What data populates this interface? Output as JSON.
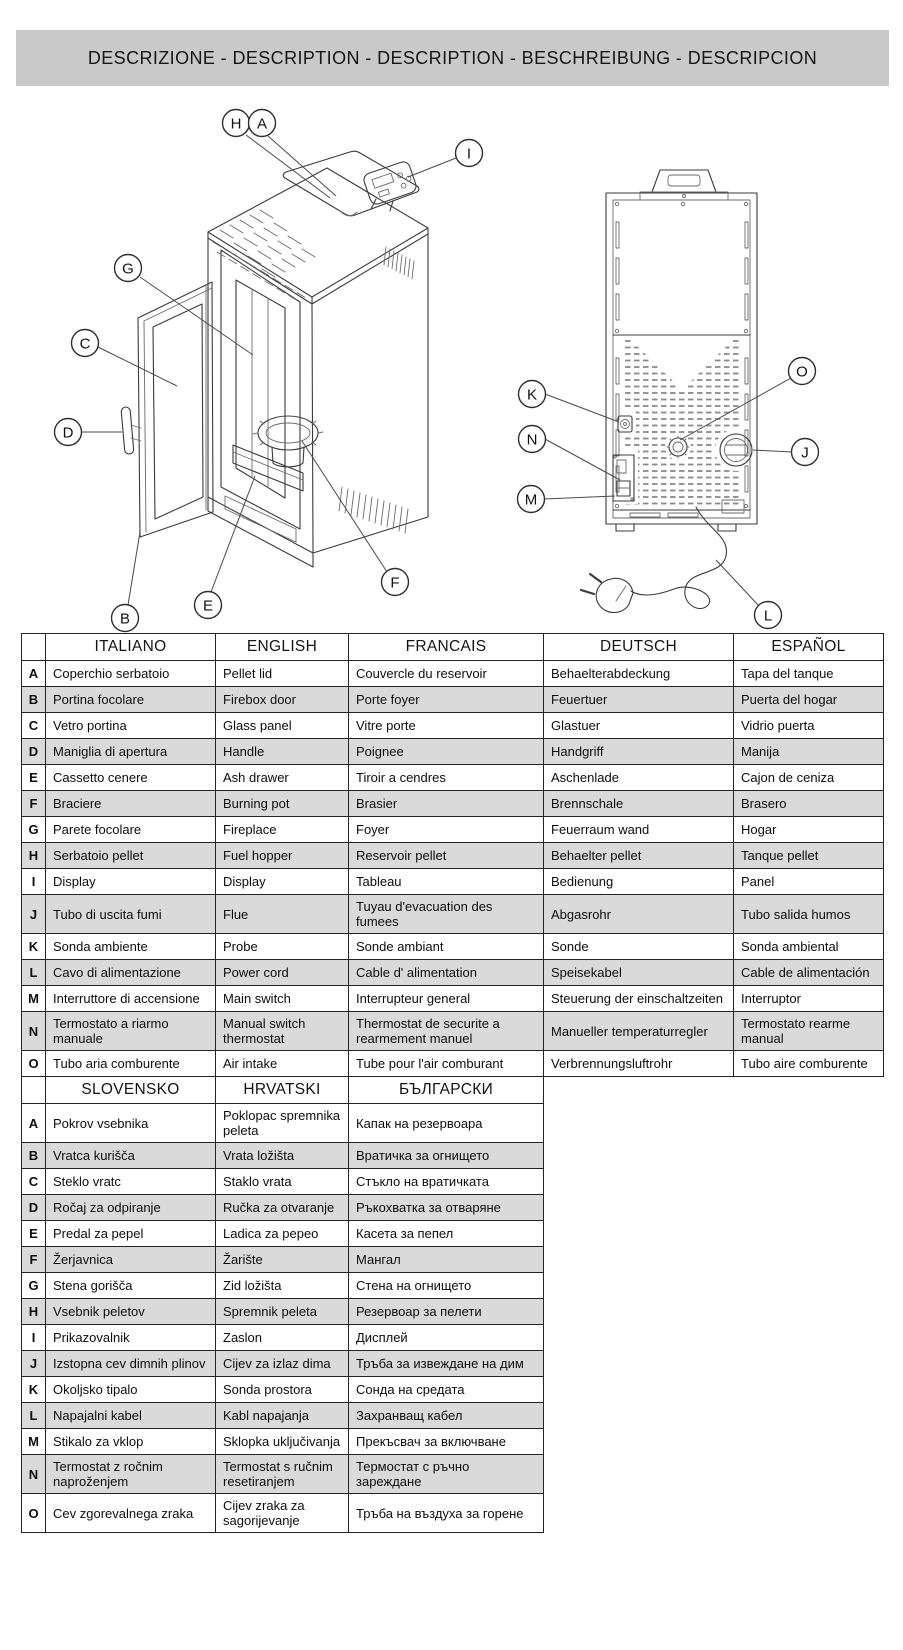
{
  "banner": {
    "title": "DESCRIZIONE - DESCRIPTION - DESCRIPTION - BESCHREIBUNG - DESCRIPCION"
  },
  "colors": {
    "banner_bg": "#c9c9c9",
    "row_alt_bg": "#dadada",
    "border": "#242424",
    "line_art": "#3b3b3b"
  },
  "diagrams": {
    "front": {
      "name": "stove-front-view",
      "callouts": [
        {
          "label": "H",
          "cx": 196,
          "cy": 28,
          "leader": [
            206,
            40,
            290,
            103
          ]
        },
        {
          "label": "A",
          "cx": 222,
          "cy": 28,
          "leader": [
            228,
            41,
            296,
            101
          ]
        },
        {
          "label": "I",
          "cx": 429,
          "cy": 58,
          "leader": [
            416,
            63,
            368,
            82
          ]
        },
        {
          "label": "G",
          "cx": 88,
          "cy": 173,
          "leader": [
            100,
            182,
            213,
            260
          ]
        },
        {
          "label": "C",
          "cx": 45,
          "cy": 248,
          "leader": [
            58,
            252,
            137,
            291
          ]
        },
        {
          "label": "D",
          "cx": 28,
          "cy": 337,
          "leader": [
            41,
            337,
            82,
            337
          ]
        },
        {
          "label": "B",
          "cx": 85,
          "cy": 523,
          "leader": [
            88,
            510,
            100,
            437
          ]
        },
        {
          "label": "E",
          "cx": 168,
          "cy": 510,
          "leader": [
            171,
            497,
            215,
            381
          ]
        },
        {
          "label": "F",
          "cx": 355,
          "cy": 487,
          "leader": [
            347,
            477,
            262,
            346
          ]
        }
      ]
    },
    "rear": {
      "name": "stove-rear-view",
      "callouts": [
        {
          "label": "K",
          "cx": 52,
          "cy": 264,
          "leader": [
            65,
            264,
            139,
            292
          ]
        },
        {
          "label": "N",
          "cx": 52,
          "cy": 309,
          "leader": [
            65,
            309,
            140,
            350
          ]
        },
        {
          "label": "M",
          "cx": 51,
          "cy": 369,
          "leader": [
            64,
            369,
            135,
            366
          ]
        },
        {
          "label": "O",
          "cx": 322,
          "cy": 241,
          "leader": [
            311,
            248,
            200,
            310
          ]
        },
        {
          "label": "J",
          "cx": 325,
          "cy": 322,
          "leader": [
            312,
            322,
            273,
            320
          ]
        },
        {
          "label": "L",
          "cx": 288,
          "cy": 485,
          "leader": [
            279,
            476,
            236,
            430
          ]
        }
      ]
    }
  },
  "table1": {
    "headers": [
      "",
      "ITALIANO",
      "ENGLISH",
      "FRANCAIS",
      "DEUTSCH",
      "ESPAÑOL"
    ],
    "col_widths": [
      24,
      170,
      133,
      195,
      190,
      150
    ],
    "rows": [
      {
        "key": "A",
        "cells": [
          "Coperchio serbatoio",
          "Pellet lid",
          "Couvercle du reservoir",
          "Behaelterabdeckung",
          "Tapa del tanque"
        ]
      },
      {
        "key": "B",
        "cells": [
          "Portina focolare",
          "Firebox door",
          "Porte foyer",
          "Feuertuer",
          "Puerta del hogar"
        ]
      },
      {
        "key": "C",
        "cells": [
          "Vetro portina",
          "Glass panel",
          "Vitre porte",
          "Glastuer",
          "Vidrio puerta"
        ]
      },
      {
        "key": "D",
        "cells": [
          "Maniglia di apertura",
          "Handle",
          "Poignee",
          "Handgriff",
          "Manija"
        ]
      },
      {
        "key": "E",
        "cells": [
          "Cassetto cenere",
          "Ash drawer",
          "Tiroir a cendres",
          "Aschenlade",
          "Cajon de ceniza"
        ]
      },
      {
        "key": "F",
        "cells": [
          "Braciere",
          "Burning pot",
          "Brasier",
          "Brennschale",
          "Brasero"
        ]
      },
      {
        "key": "G",
        "cells": [
          "Parete focolare",
          "Fireplace",
          "Foyer",
          "Feuerraum wand",
          "Hogar"
        ]
      },
      {
        "key": "H",
        "cells": [
          "Serbatoio pellet",
          "Fuel hopper",
          "Reservoir pellet",
          "Behaelter pellet",
          "Tanque pellet"
        ]
      },
      {
        "key": "I",
        "cells": [
          "Display",
          "Display",
          "Tableau",
          "Bedienung",
          "Panel"
        ]
      },
      {
        "key": "J",
        "cells": [
          "Tubo di uscita fumi",
          "Flue",
          "Tuyau d'evacuation des fumees",
          "Abgasrohr",
          "Tubo salida humos"
        ]
      },
      {
        "key": "K",
        "cells": [
          "Sonda ambiente",
          "Probe",
          "Sonde ambiant",
          "Sonde",
          "Sonda ambiental"
        ]
      },
      {
        "key": "L",
        "cells": [
          "Cavo di alimentazione",
          "Power cord",
          "Cable d' alimentation",
          "Speisekabel",
          "Cable de alimentación"
        ]
      },
      {
        "key": "M",
        "cells": [
          "Interruttore di accensione",
          "Main switch",
          "Interrupteur general",
          "Steuerung der einschaltzeiten",
          "Interruptor"
        ]
      },
      {
        "key": "N",
        "cells": [
          "Termostato a riarmo manuale",
          "Manual switch thermostat",
          "Thermostat de securite a rearmement manuel",
          "Manueller temperaturregler",
          "Termostato rearme manual"
        ]
      },
      {
        "key": "O",
        "cells": [
          "Tubo aria comburente",
          "Air intake",
          "Tube pour l'air comburant",
          "Verbrennungsluftrohr",
          "Tubo aire comburente"
        ]
      }
    ]
  },
  "table2": {
    "headers": [
      "",
      "SLOVENSKO",
      "HRVATSKI",
      "БЪЛГАРСКИ"
    ],
    "col_widths": [
      24,
      170,
      133,
      195
    ],
    "rows": [
      {
        "key": "A",
        "cells": [
          "Pokrov vsebnika",
          "Poklopac spremnika peleta",
          "Капак на резервоара"
        ]
      },
      {
        "key": "B",
        "cells": [
          "Vratca kurišča",
          "Vrata ložišta",
          "Вратичка за огнището"
        ]
      },
      {
        "key": "C",
        "cells": [
          "Steklo vratc",
          "Staklo vrata",
          "Стъкло на вратичката"
        ]
      },
      {
        "key": "D",
        "cells": [
          "Ročaj za odpiranje",
          "Ručka za otvaranje",
          "Ръкохватка за отваряне"
        ]
      },
      {
        "key": "E",
        "cells": [
          "Predal za pepel",
          "Ladica za pepeo",
          "Касета за пепел"
        ]
      },
      {
        "key": "F",
        "cells": [
          "Žerjavnica",
          "Žarište",
          "Мангал"
        ]
      },
      {
        "key": "G",
        "cells": [
          "Stena gorišča",
          "Zid ložišta",
          "Стена на огнището"
        ]
      },
      {
        "key": "H",
        "cells": [
          "Vsebnik peletov",
          "Spremnik peleta",
          "Резервоар за пелети"
        ]
      },
      {
        "key": "I",
        "cells": [
          "Prikazovalnik",
          "Zaslon",
          "Дисплей"
        ]
      },
      {
        "key": "J",
        "cells": [
          "Izstopna cev dimnih plinov",
          "Cijev za izlaz dima",
          "Тръба за извеждане на дим"
        ]
      },
      {
        "key": "K",
        "cells": [
          "Okoljsko tipalo",
          "Sonda prostora",
          "Сонда на средата"
        ]
      },
      {
        "key": "L",
        "cells": [
          "Napajalni kabel",
          "Kabl napajanja",
          "Захранващ кабел"
        ]
      },
      {
        "key": "M",
        "cells": [
          "Stikalo za vklop",
          "Sklopka uključivanja",
          "Прекъсвач за включване"
        ]
      },
      {
        "key": "N",
        "cells": [
          "Termostat z ročnim naproženjem",
          "Termostat s ručnim resetiranjem",
          "Термостат с ръчно зареждане"
        ]
      },
      {
        "key": "O",
        "cells": [
          "Cev zgorevalnega zraka",
          "Cijev zraka za sagorijevanje",
          "Тръба на въздуха за горене"
        ]
      }
    ]
  }
}
